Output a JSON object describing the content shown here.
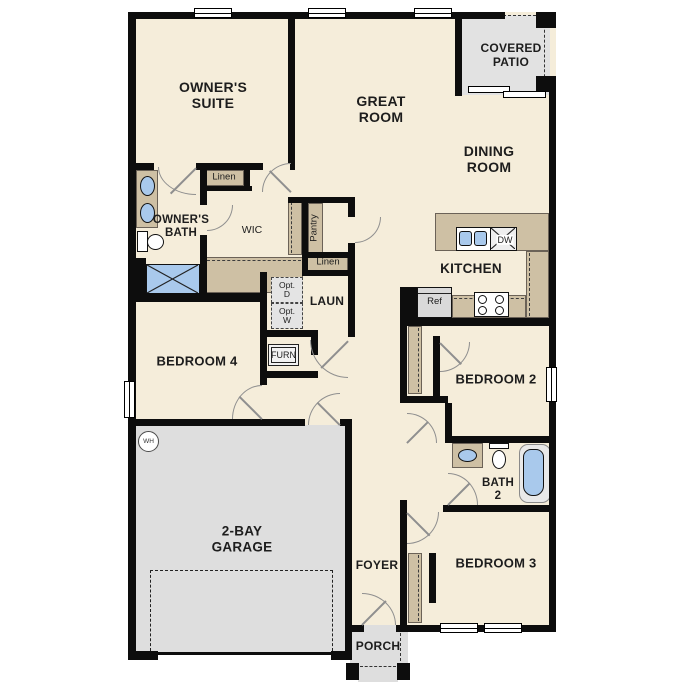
{
  "colors": {
    "wall": "#0d0d0d",
    "floor": "#f5edda",
    "cabinet": "#cec0a4",
    "concrete": "#dedede",
    "fixture": "#a9c9ec"
  },
  "plan": {
    "rooms": {
      "owners_suite": "OWNER'S\nSUITE",
      "great_room": "GREAT\nROOM",
      "covered_patio": "COVERED\nPATIO",
      "dining_room": "DINING\nROOM",
      "owners_bath": "OWNER'S\nBATH",
      "wic": "WIC",
      "kitchen": "KITCHEN",
      "laundry": "LAUN",
      "bedroom_4": "BEDROOM 4",
      "bedroom_2": "BEDROOM 2",
      "bath_2": "BATH\n2",
      "bedroom_3": "BEDROOM 3",
      "foyer": "FOYER",
      "garage": "2-BAY\nGARAGE",
      "porch": "PORCH"
    },
    "closets": {
      "linen_upper": "Linen",
      "pantry": "Pantry",
      "linen_lower": "Linen"
    },
    "appliances": {
      "refrigerator": "Ref",
      "dishwasher": "DW",
      "furnace": "FURN",
      "water_heater": "WH",
      "optional_dryer": "Opt.\nD",
      "optional_washer": "Opt.\nW"
    }
  }
}
